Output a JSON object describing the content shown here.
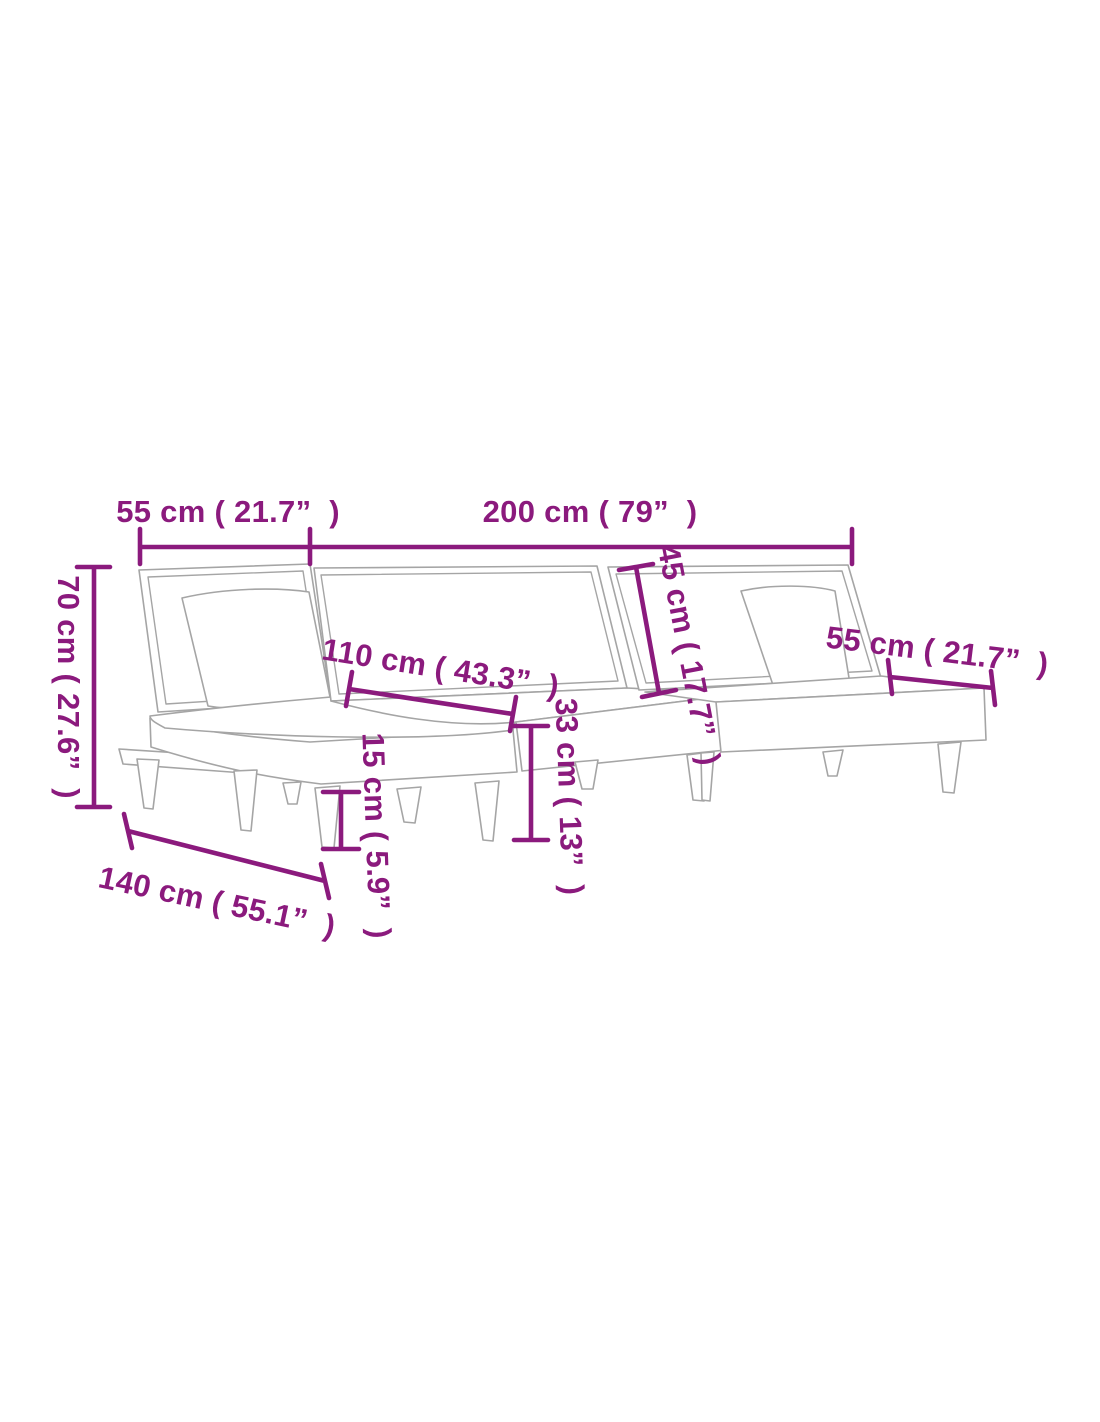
{
  "page": {
    "background_color": "#ffffff",
    "description": "L-shaped sofa bed dimension diagram line drawing"
  },
  "diagram": {
    "accent_color": "#8B1A7D",
    "line_art_color": "#A5A5A5",
    "dimensions": {
      "backrest_left_width": "55 cm ( 21.7”  )",
      "sofa_length": "200 cm ( 79”  )",
      "total_height": "70 cm ( 27.6”  )",
      "chaise_seat_length": "110 cm ( 43.3”  )",
      "backrest_height": "45 cm ( 17.7”  )",
      "backrest_right_width": "55 cm ( 21.7”  )",
      "seat_height": "33 cm ( 13”  )",
      "leg_height": "15 cm ( 5.9”  )",
      "chaise_length": "140 cm ( 55.1”  )"
    }
  }
}
